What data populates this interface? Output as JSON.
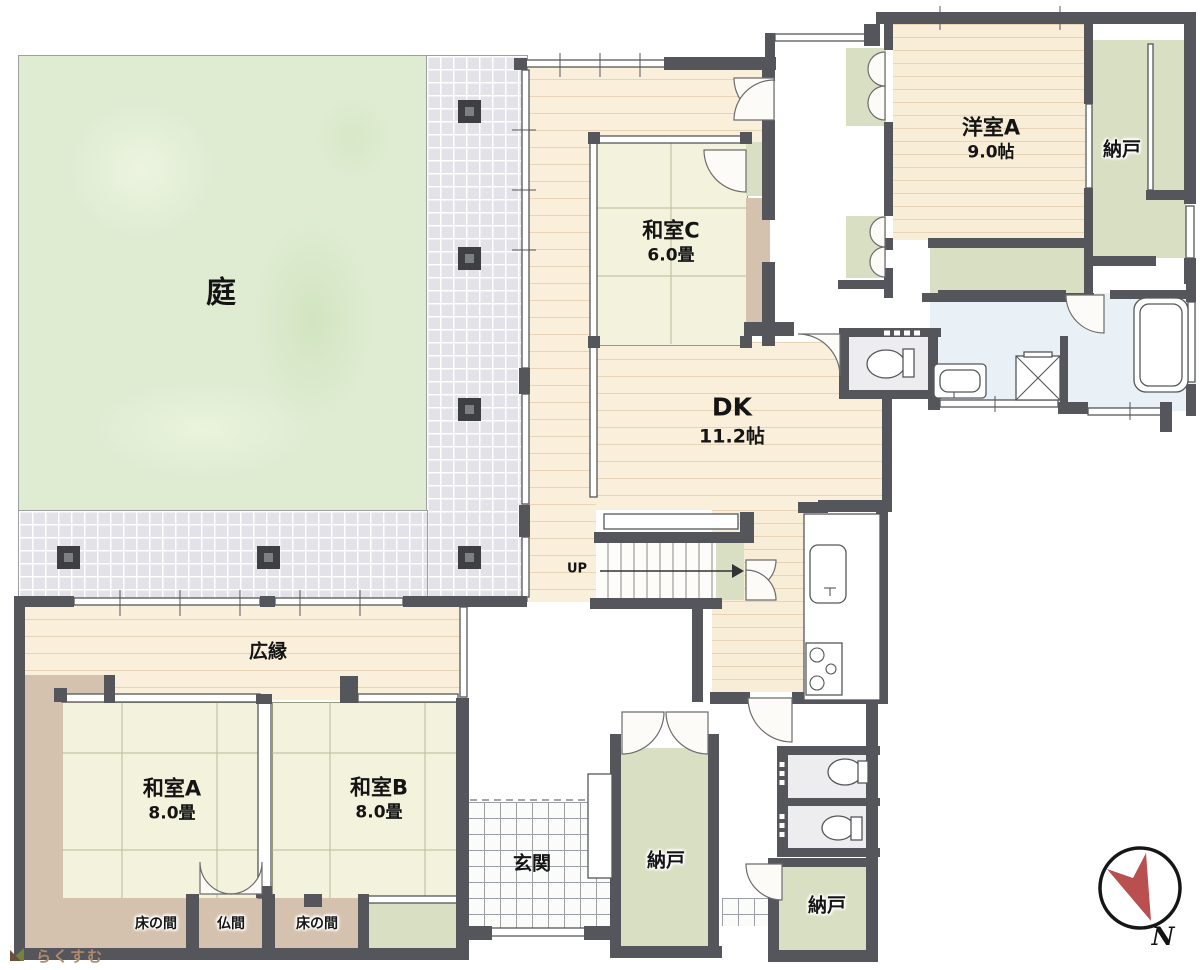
{
  "plan": {
    "rooms": [
      {
        "id": "garden",
        "label": "庭",
        "size": ""
      },
      {
        "id": "washitsu-c",
        "label": "和室C",
        "size": "6.0畳"
      },
      {
        "id": "dk",
        "label": "DK",
        "size": "11.2帖"
      },
      {
        "id": "yoshitsu-a",
        "label": "洋室A",
        "size": "9.0帖"
      },
      {
        "id": "nando-top-right",
        "label": "納戸",
        "size": ""
      },
      {
        "id": "hiroen",
        "label": "広縁",
        "size": ""
      },
      {
        "id": "washitsu-a",
        "label": "和室A",
        "size": "8.0畳"
      },
      {
        "id": "washitsu-b",
        "label": "和室B",
        "size": "8.0畳"
      },
      {
        "id": "tokonoma-a",
        "label": "床の間",
        "size": ""
      },
      {
        "id": "butsuma",
        "label": "仏間",
        "size": ""
      },
      {
        "id": "tokonoma-b",
        "label": "床の間",
        "size": ""
      },
      {
        "id": "genkan",
        "label": "玄関",
        "size": ""
      },
      {
        "id": "nando-center",
        "label": "納戸",
        "size": ""
      },
      {
        "id": "nando-bottom-right",
        "label": "納戸",
        "size": ""
      }
    ],
    "stairs": {
      "label": "UP"
    },
    "compass": {
      "label": "N",
      "arrow_color": "#b9504f"
    },
    "watermark": {
      "text": "らくすむ"
    },
    "colors": {
      "wall": "#54565b",
      "garden": "#dfecd2",
      "tile": "#e2e2e8",
      "wood": "#f9efda",
      "tatami": "#f3f2dc",
      "closet_green": "#d9dfc2",
      "tokonoma_tan": "#d5c2ae",
      "wet_blue": "#e9f1f6",
      "compass_red": "#b9504f"
    }
  }
}
